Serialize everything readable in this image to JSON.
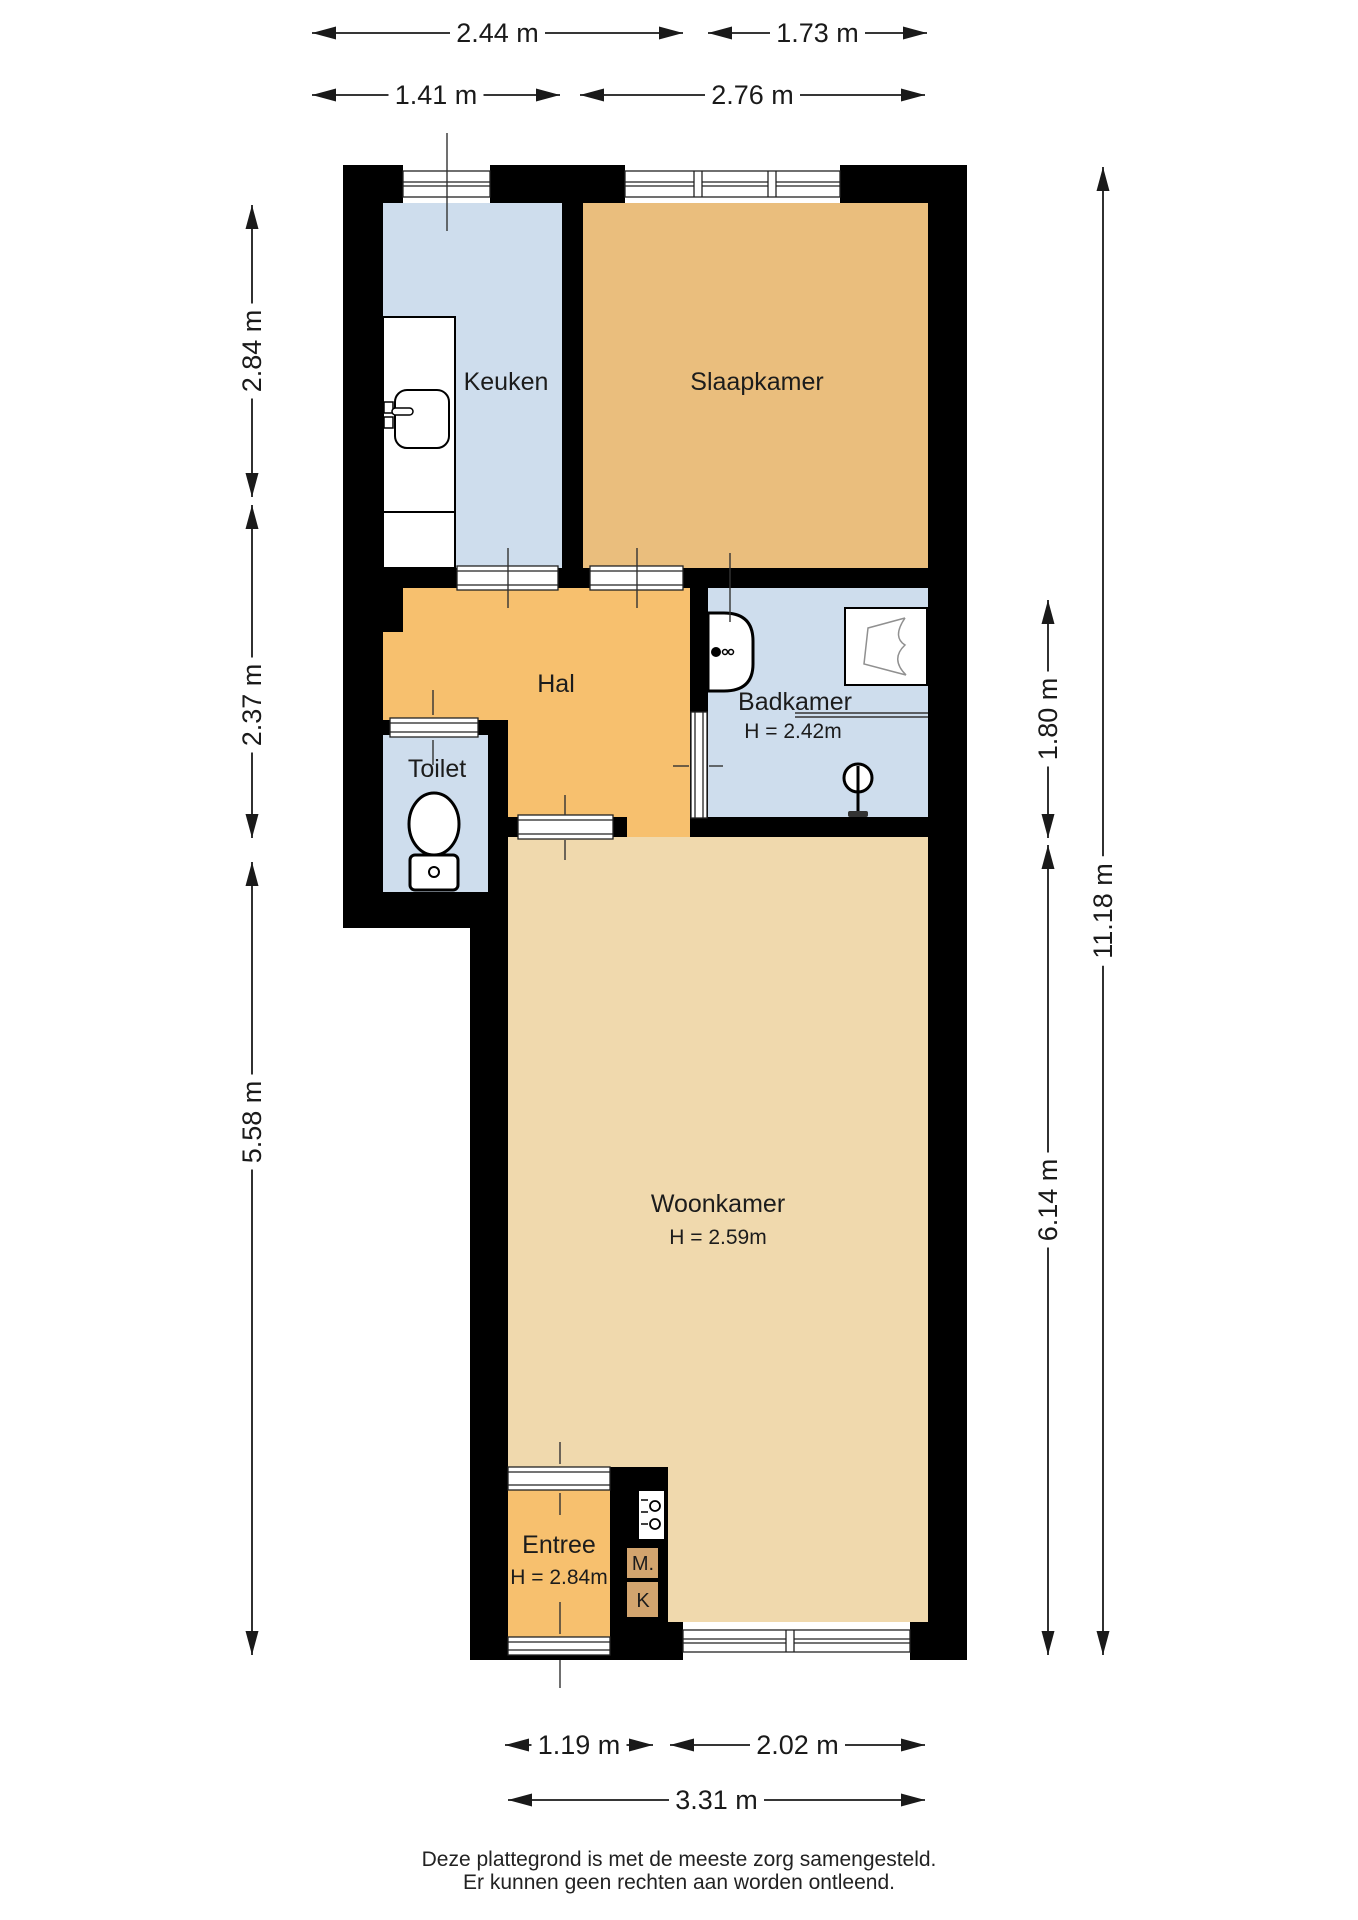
{
  "rooms": {
    "keuken": {
      "label": "Keuken"
    },
    "slaapkamer": {
      "label": "Slaapkamer"
    },
    "hal": {
      "label": "Hal"
    },
    "toilet": {
      "label": "Toilet"
    },
    "badkamer": {
      "label": "Badkamer",
      "height": "H = 2.42m"
    },
    "woonkamer": {
      "label": "Woonkamer",
      "height": "H = 2.59m"
    },
    "entree": {
      "label": "Entree",
      "height": "H = 2.84m"
    },
    "meterkast": {
      "label": "M."
    },
    "kast": {
      "label": "K"
    }
  },
  "dimensions": {
    "top": [
      "2.44 m",
      "1.73 m",
      "1.41 m",
      "2.76 m"
    ],
    "left": [
      "2.84 m",
      "2.37 m",
      "5.58 m"
    ],
    "right": [
      "1.80 m",
      "6.14 m",
      "11.18 m"
    ],
    "bottom": [
      "1.19 m",
      "2.02 m",
      "3.31 m"
    ]
  },
  "colors": {
    "wall": "#000000",
    "wet_room": "#cedded",
    "bedroom": "#eabe7d",
    "hall": "#f7c06e",
    "living_room": "#f0d9ad",
    "closet": "#d2a46e",
    "background": "#ffffff"
  },
  "footer": {
    "line1": "Deze plattegrond is met de meeste zorg samengesteld.",
    "line2": "Er kunnen geen rechten aan worden ontleend."
  }
}
